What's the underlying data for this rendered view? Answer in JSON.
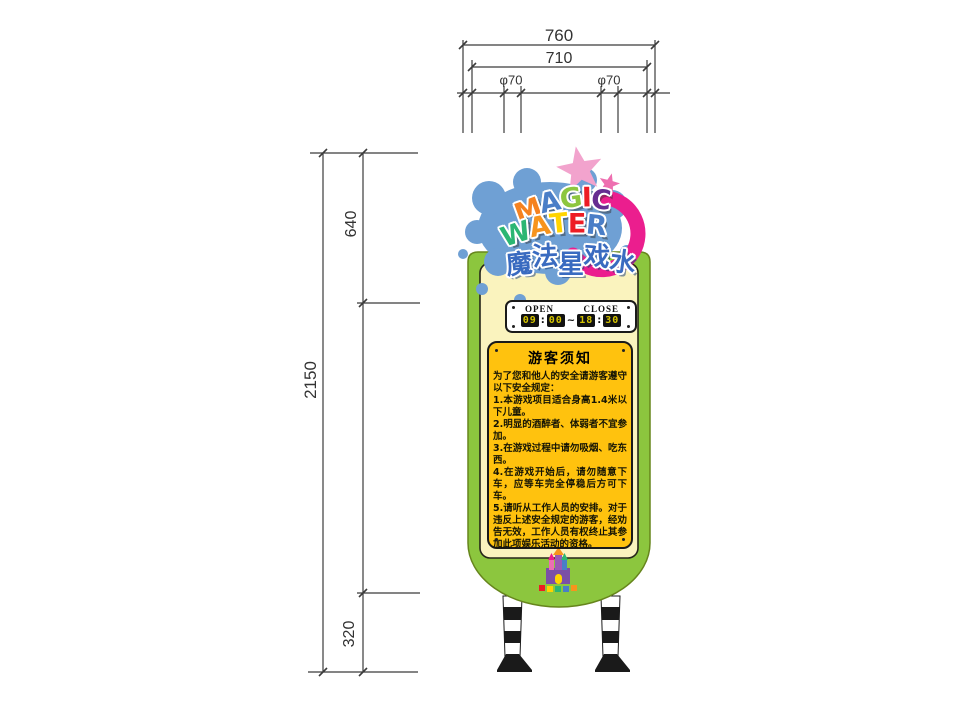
{
  "dimensions": {
    "top": {
      "overall": "760",
      "inner": "710",
      "pole_left": "φ70",
      "pole_right": "φ70"
    },
    "side": {
      "total": "2150",
      "upper": "640",
      "lower": "320"
    }
  },
  "logo": {
    "magic_letters": [
      {
        "ch": "M",
        "color": "#F58220"
      },
      {
        "ch": "A",
        "color": "#4A7EC7"
      },
      {
        "ch": "G",
        "color": "#8DC63F"
      },
      {
        "ch": "I",
        "color": "#ED1C24"
      },
      {
        "ch": "C",
        "color": "#662D91"
      }
    ],
    "water_letters": [
      {
        "ch": "W",
        "color": "#2BB673"
      },
      {
        "ch": "A",
        "color": "#F7941D"
      },
      {
        "ch": "T",
        "color": "#FFD400"
      },
      {
        "ch": "E",
        "color": "#ED1C24"
      },
      {
        "ch": "R",
        "color": "#4A7EC7"
      }
    ],
    "title_cn_chars": [
      {
        "ch": "魔"
      },
      {
        "ch": "法"
      },
      {
        "ch": "星"
      },
      {
        "ch": "戏"
      },
      {
        "ch": "水"
      }
    ],
    "title_cn": "魔法星戏水"
  },
  "hours": {
    "open_label": "OPEN",
    "close_label": "CLOSE",
    "open_hour": "09",
    "open_min": "00",
    "close_hour": "18",
    "close_min": "30",
    "colon": ":",
    "tilde": "~"
  },
  "notice": {
    "title": "游客须知",
    "intro": "为了您和他人的安全请游客遵守以下安全规定：",
    "rules": [
      "1.本游戏项目适合身高1.4米以下儿童。",
      "2.明显的酒醉者、体弱者不宜参加。",
      "3.在游戏过程中请勿吸烟、吃东西。",
      "4.在游戏开始后，请勿随意下车，应等车完全停稳后方可下车。",
      "5.请听从工作人员的安排。对于违反上述安全规定的游客，经劝告无效，工作人员有权终止其参加此项娱乐活动的资格。"
    ]
  },
  "colors": {
    "board_green": "#8CC63E",
    "panel_cream": "#FAF3BE",
    "notice_yellow": "#FFC20E",
    "splash_blue": "#6FA0D4",
    "ring_pink": "#EB1E8E",
    "star_light_pink": "#F2A3CD",
    "star_dark_pink": "#EE6FB0",
    "cn_blue": "#3A6BC0",
    "digit_yellow": "#D6C500",
    "dimension_line": "#3b3b3b"
  }
}
